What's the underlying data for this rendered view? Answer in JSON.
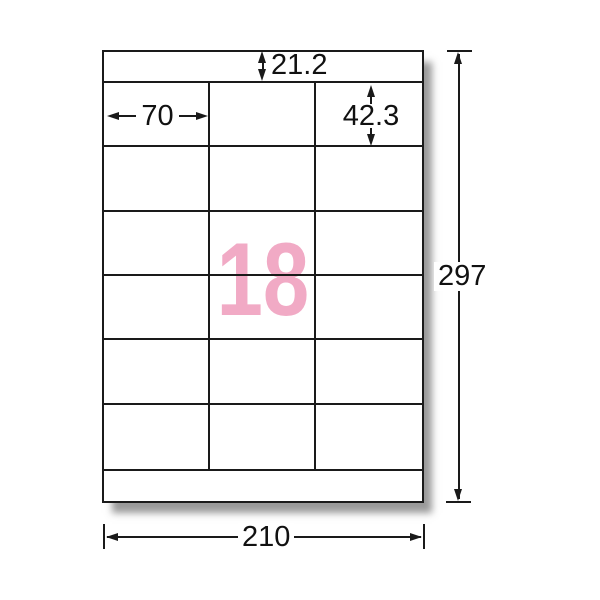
{
  "sheet": {
    "count_label": "18",
    "grid": {
      "columns": 3,
      "rows": 6
    },
    "colors": {
      "count_pink": "#f1aac5",
      "line": "#1a1a1a",
      "paper": "#ffffff"
    }
  },
  "dimensions": {
    "top_margin": "21.2",
    "label_width": "70",
    "label_height": "42.3",
    "sheet_height": "297",
    "sheet_width": "210"
  }
}
